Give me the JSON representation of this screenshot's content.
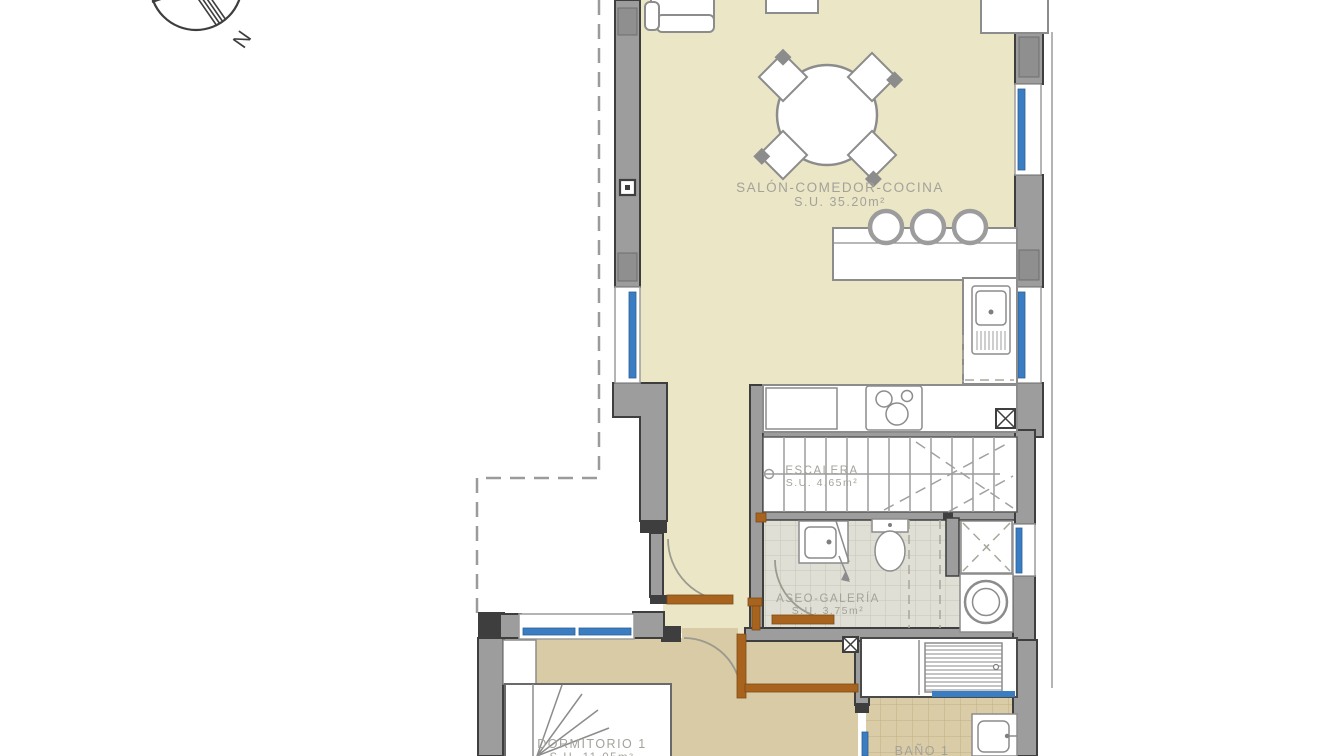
{
  "plan": {
    "type": "floor-plan",
    "floor_background": "#ffffff"
  },
  "colors": {
    "wall_gray": "#9d9d9d",
    "wall_dark": "#3e3e3e",
    "floor_living": "#eae6c6",
    "floor_hall": "#d9cba6",
    "window_blue": "#3b7dc2",
    "door_brown": "#a8641f",
    "label_gray": "#a3a29a"
  },
  "compass": {
    "label": "N"
  },
  "rooms": {
    "salon": {
      "name": "SALÓN-COMEDOR-COCINA",
      "area": "S.U. 35.20m²"
    },
    "escalera": {
      "name": "ESCALERA",
      "area": "S.U. 4.65m²"
    },
    "aseo": {
      "name": "ASEO-GALERÍA",
      "area": "S.U. 3.75m²"
    },
    "dormitorio": {
      "name": "DORMITORIO 1",
      "area": "S.U. 11.05m²"
    },
    "bano": {
      "name": "BAÑO 1"
    }
  }
}
